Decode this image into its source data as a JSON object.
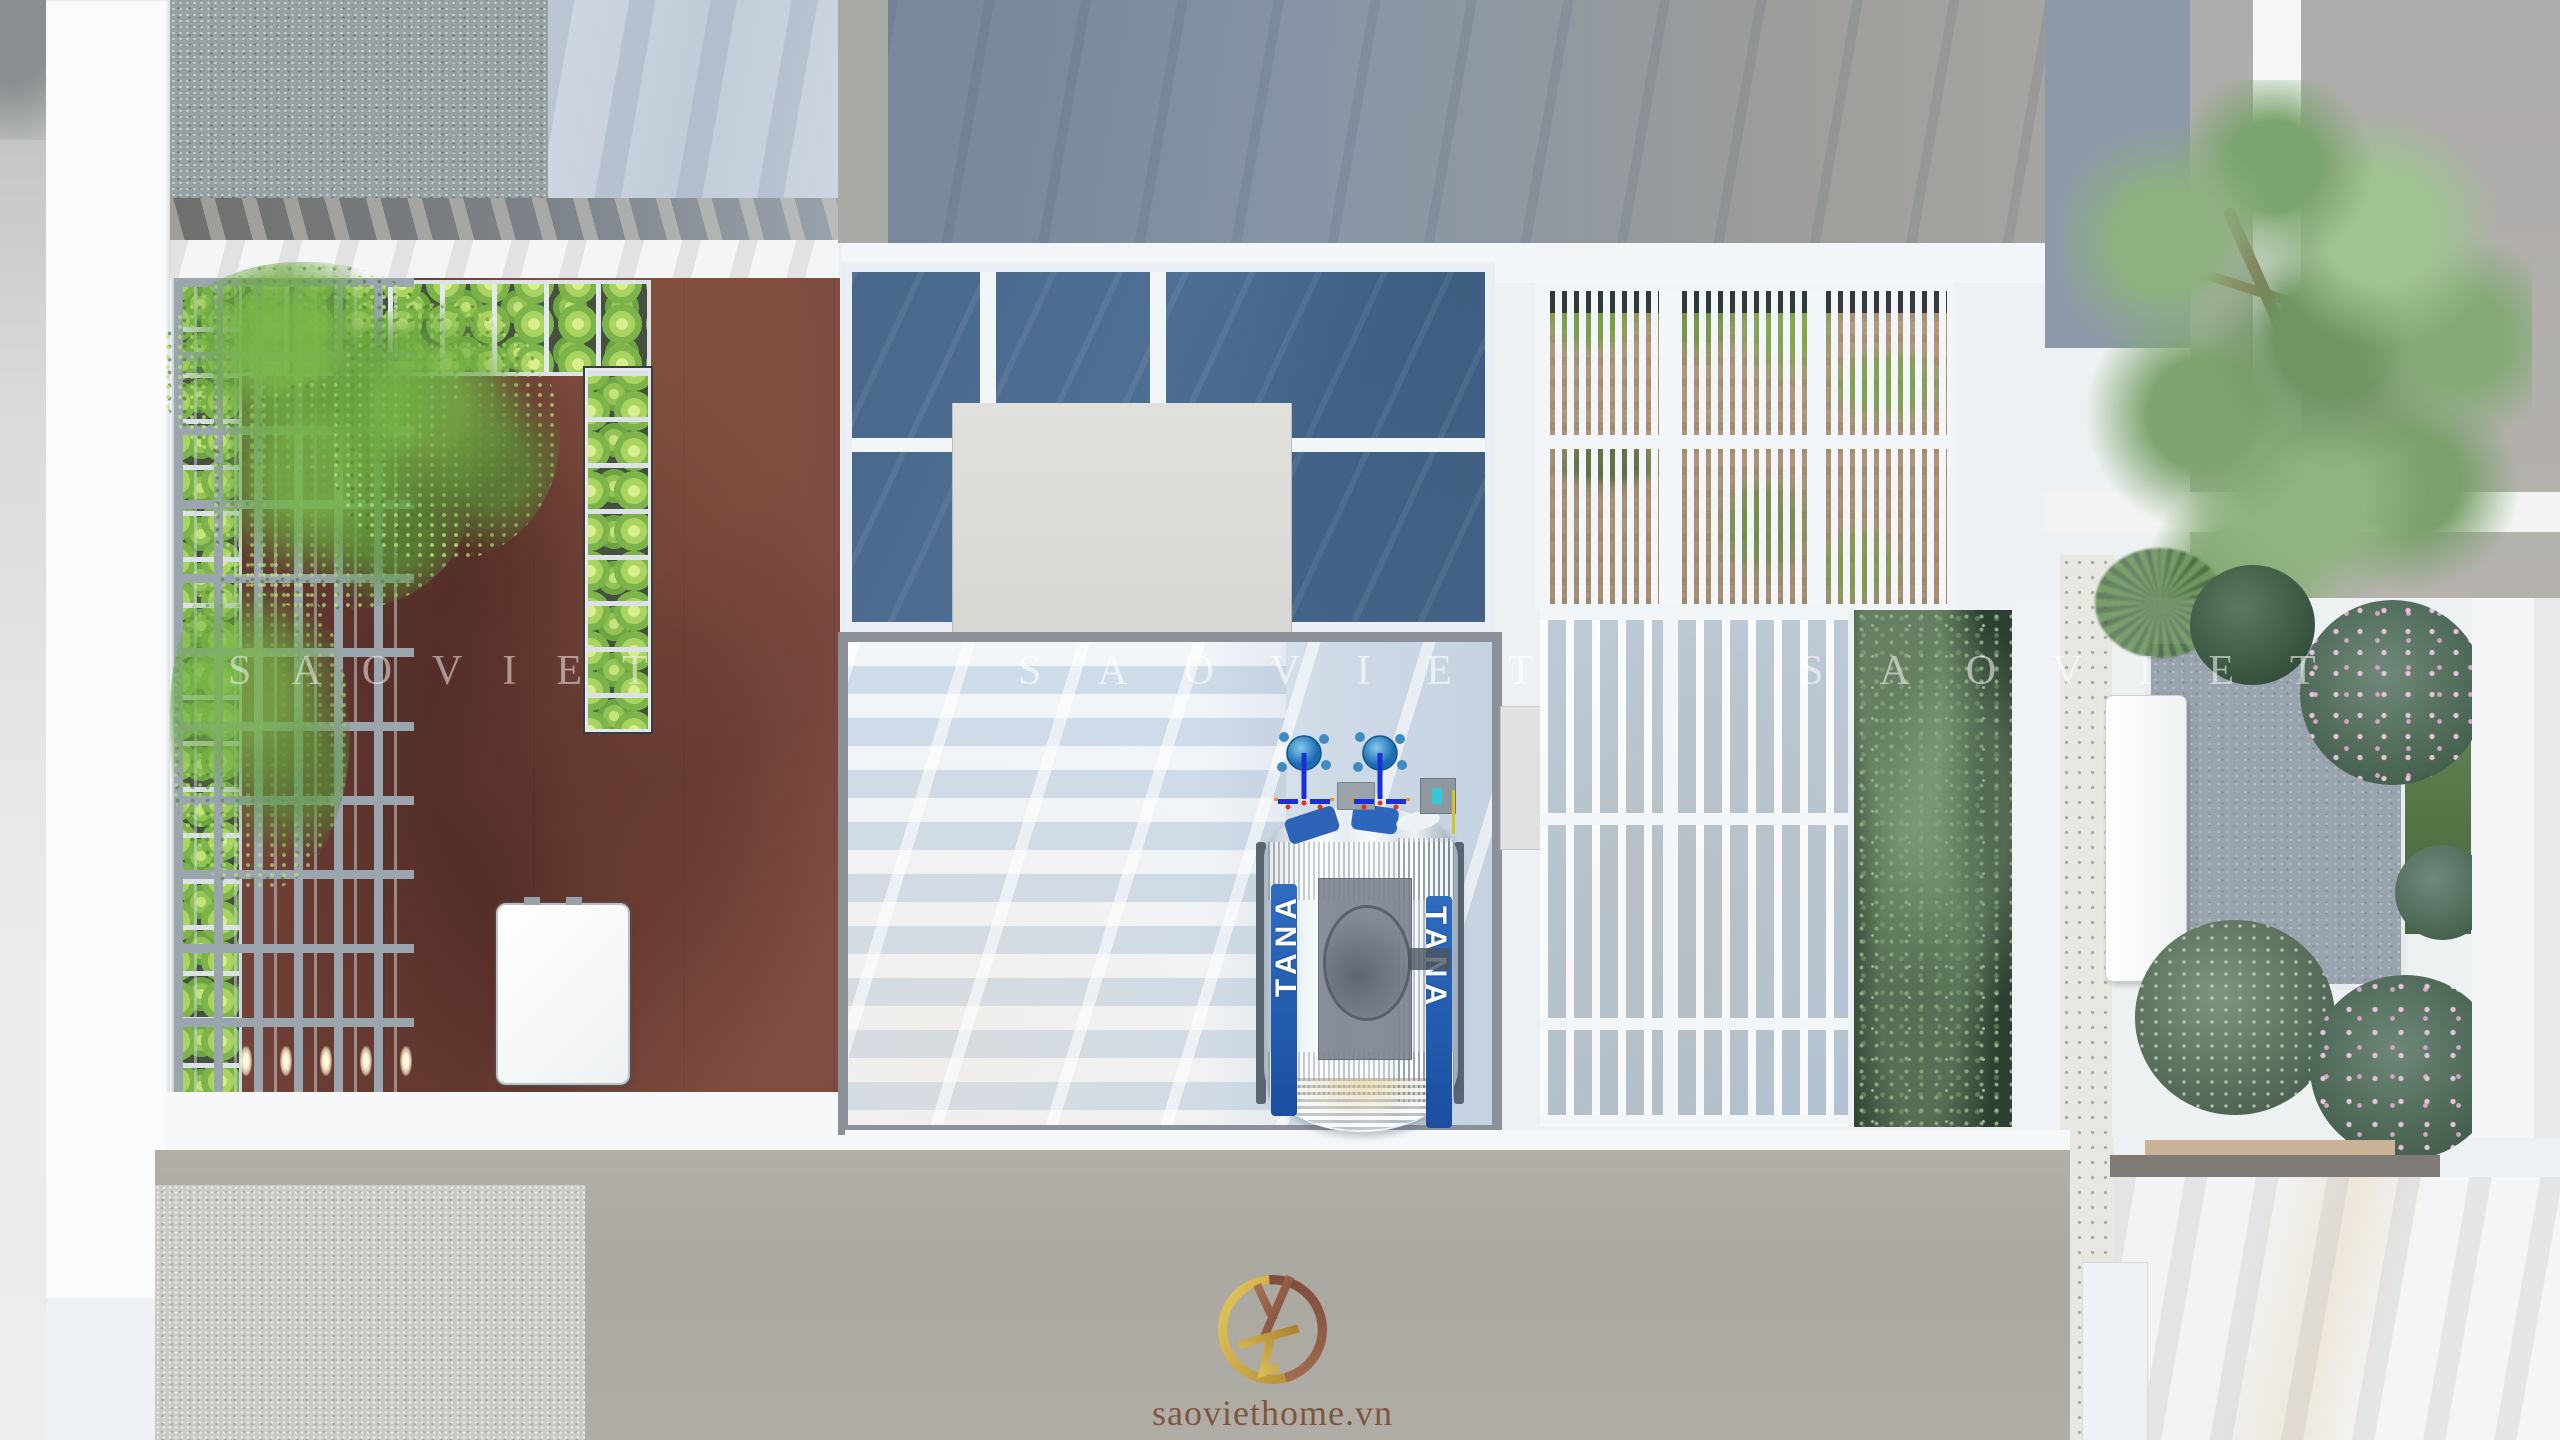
{
  "branding": {
    "watermark": "SAOVIET",
    "watermark_instances": 3,
    "logo_text": "saoviethome.vn"
  },
  "equipment": {
    "water_tank_brand": "TANA"
  },
  "palette": {
    "corten_deck": "#7b4a40",
    "dark_skylight_glass": "#4a6a8e",
    "light_skylight_glass": "#dfe9f3",
    "roof_frame_gray": "#8b9099",
    "frame_white": "#eef3f8",
    "wall_warm_gray": "#aeaaa4",
    "shadow_slate_blue": "#8695a8",
    "louver_deck_wood": "#ab9478",
    "vegetable_green": "#7fb84a",
    "pine_green": "#7d9f72",
    "flower_pink": "#d9a8c7",
    "stone_patio_gray": "#99a3ad",
    "tank_label_blue": "#2257ae",
    "valve_blue": "#1b2fd6",
    "logo_copper": "#9a674c",
    "logo_gold": "#c9a43c"
  }
}
